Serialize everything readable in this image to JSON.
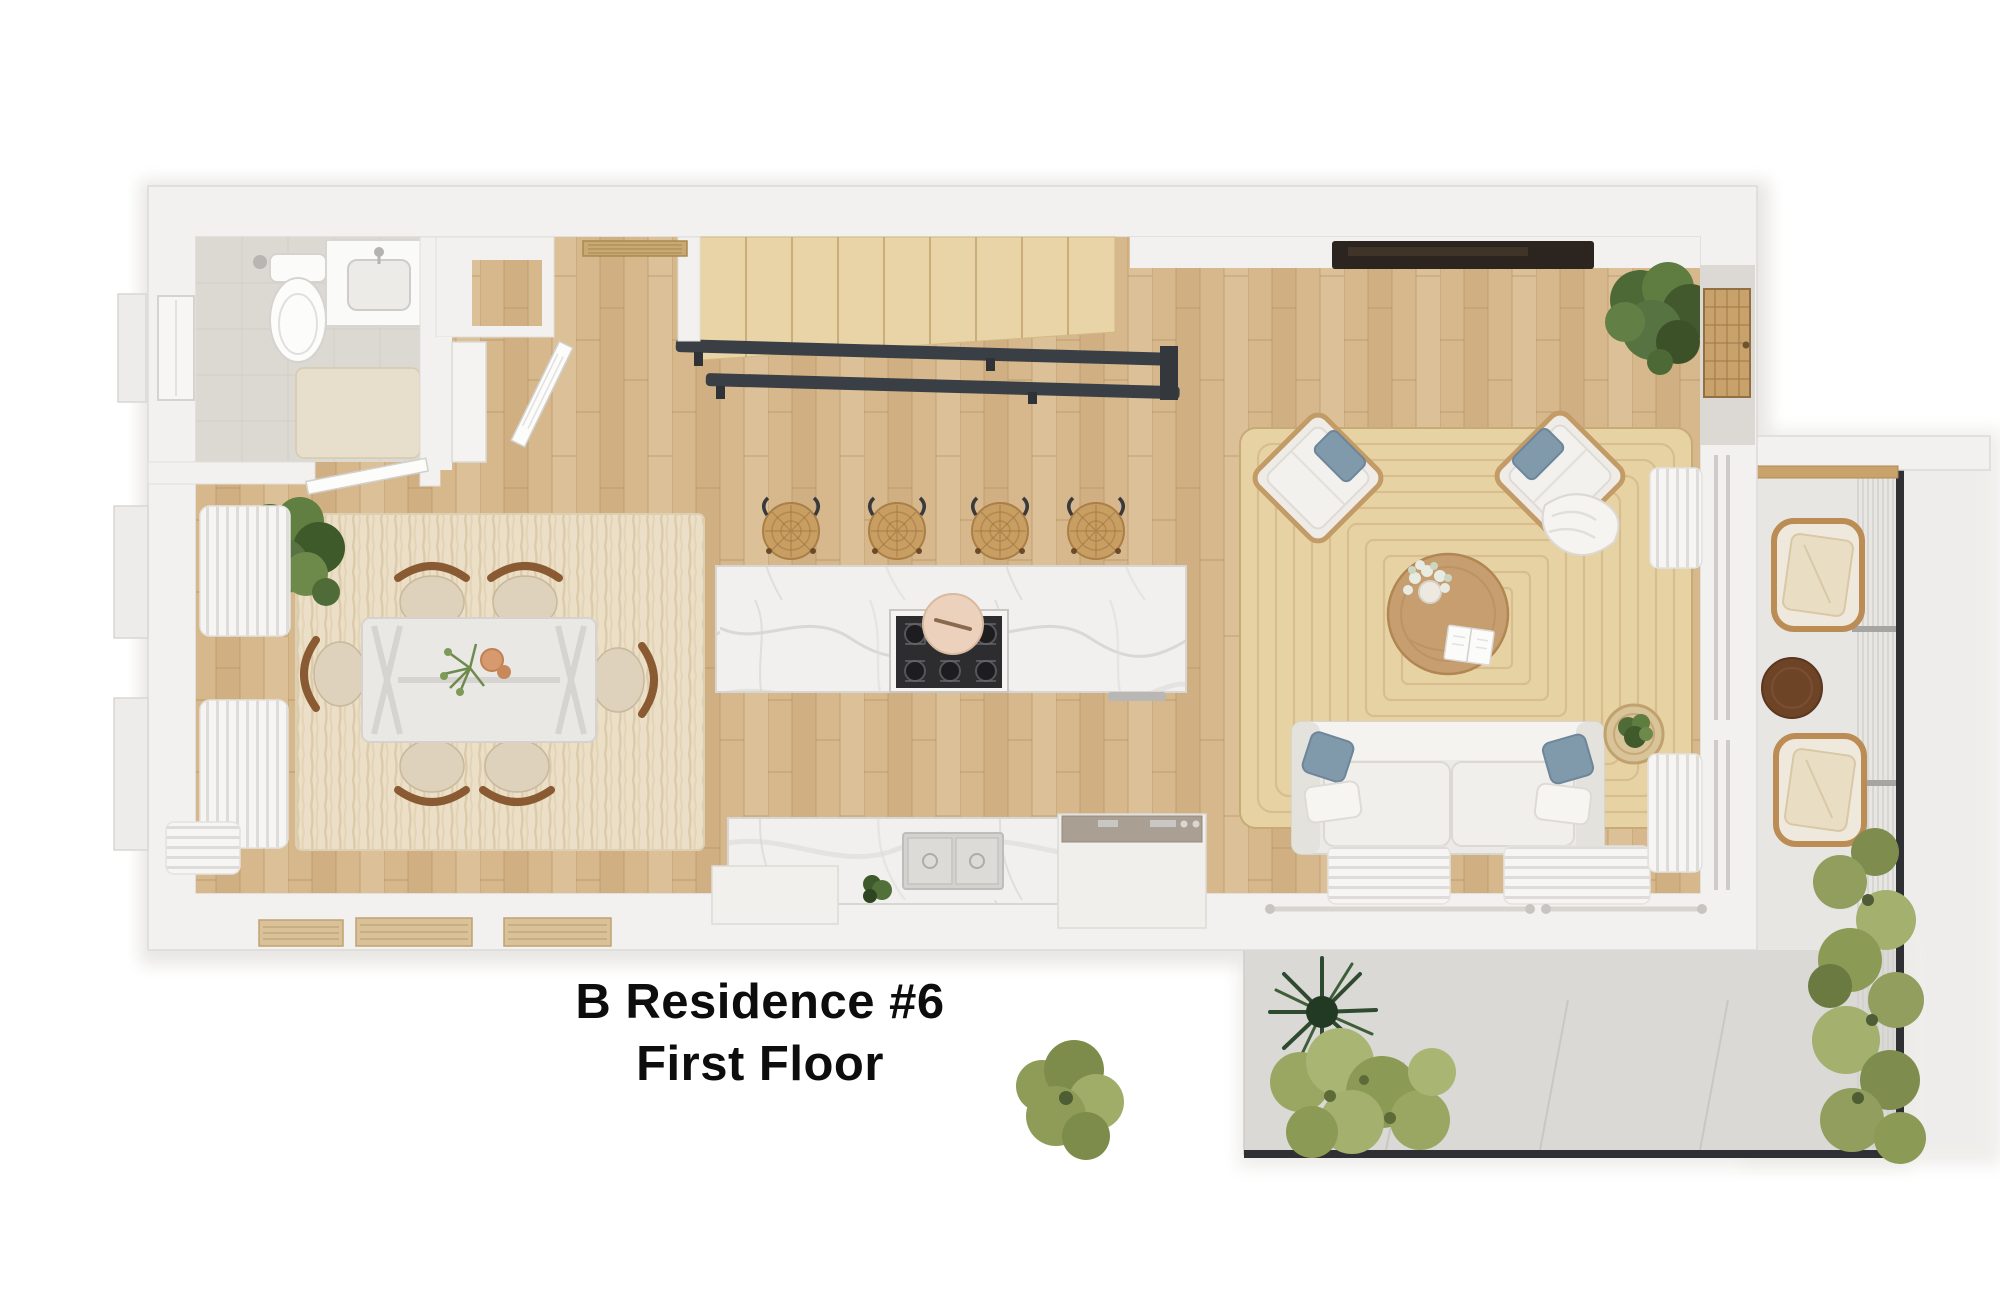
{
  "title": {
    "line1": "B Residence #6",
    "line2": "First Floor"
  },
  "palette": {
    "background": "#ffffff",
    "wall": "#f2f1ef",
    "wall_shadow": "#e2e0dc",
    "wood_floor": "#d6b88c",
    "stair_wood": "#e9d4a8",
    "marble": "#f1f0ee",
    "bathroom_tile": "#dcd8d2",
    "dining_rug": "#ecdfc8",
    "jute_rug": "#e7d2a4",
    "railing_dark": "#3a3f45",
    "pillow_blue": "#8099ab",
    "rattan": "#c89e62",
    "walnut_table": "#6e4427",
    "foliage_dark": "#2e4a2f",
    "foliage_light": "#9aa763",
    "patio_floor": "#dbd9d6",
    "title_color": "#0d0d0d"
  }
}
